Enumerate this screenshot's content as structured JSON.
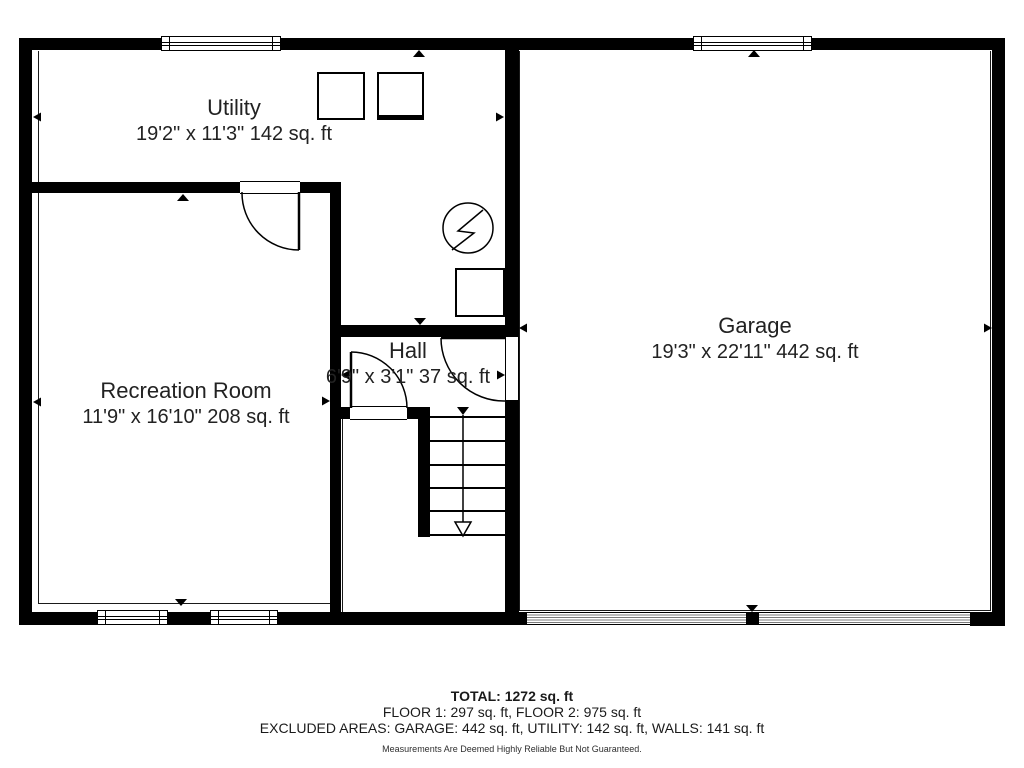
{
  "rooms": {
    "utility": {
      "name": "Utility",
      "dims": "19'2\" x 11'3\" 142 sq. ft"
    },
    "garage": {
      "name": "Garage",
      "dims": "19'3\" x 22'11\" 442 sq. ft"
    },
    "recreation": {
      "name": "Recreation Room",
      "dims": "11'9\" x 16'10\" 208 sq. ft"
    },
    "hall": {
      "name": "Hall",
      "dims": "6'9\" x 3'1\" 37 sq. ft"
    }
  },
  "summary": {
    "total": "TOTAL: 1272 sq. ft",
    "floors": "FLOOR 1: 297 sq. ft, FLOOR 2: 975 sq. ft",
    "excluded": "EXCLUDED AREAS: GARAGE: 442 sq. ft, UTILITY: 142 sq. ft, WALLS: 141 sq. ft",
    "disclaimer": "Measurements Are Deemed Highly Reliable But Not Guaranteed."
  },
  "colors": {
    "wall": "#000000",
    "background": "#ffffff",
    "garage_door_stripe": "#7a7a7a",
    "text": "#222222"
  }
}
